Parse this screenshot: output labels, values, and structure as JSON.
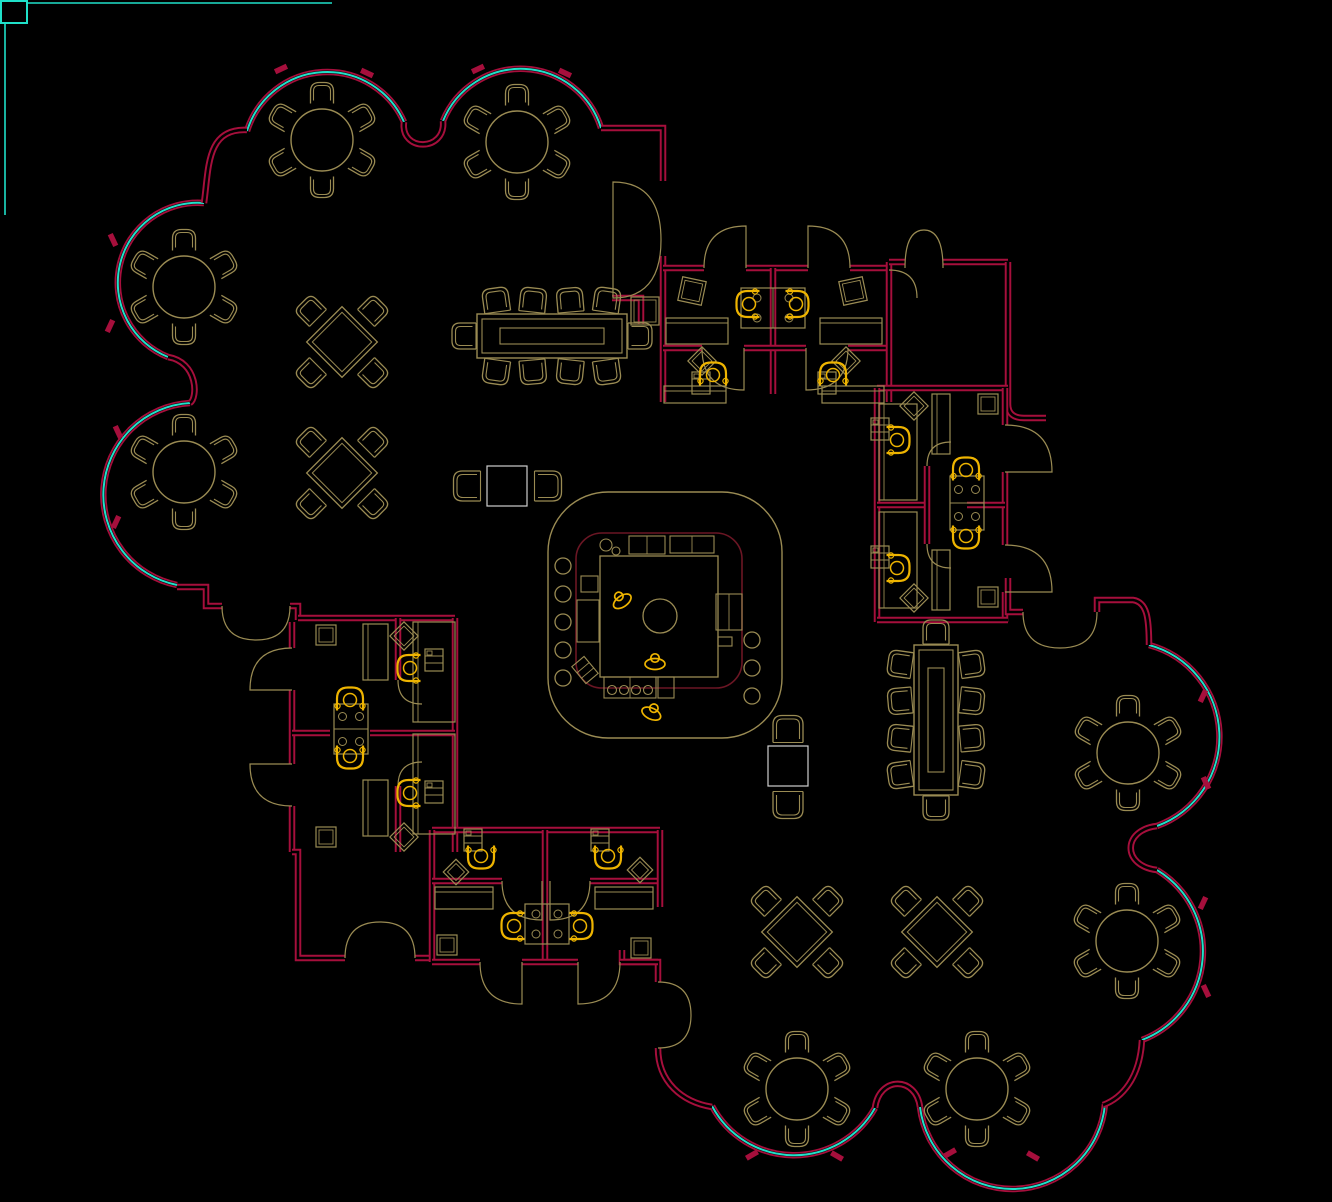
{
  "meta": {
    "type": "cad-floor-plan",
    "canvas_w": 1332,
    "canvas_h": 1202,
    "background": "#000000"
  },
  "palette": {
    "wall": "#a60f3c",
    "wall_core": "#000000",
    "glass": "#1fe0c9",
    "furniture": "#9a8b53",
    "task_chair": "#eeb400",
    "inner_line": "#6b1624",
    "light_table": "#cfcfcf",
    "frame": "#1fe0c9"
  },
  "frame": {
    "square": [
      1,
      1,
      26,
      22
    ],
    "lines": [
      [
        27,
        3,
        332,
        3
      ],
      [
        5,
        23,
        5,
        215
      ]
    ]
  },
  "plan": {
    "walls": [
      "M247,130 C206,128 209,168 204,203",
      "M601,128 L663,128 L663,181",
      "M612,298 L641,298 L641,324",
      "M663,256 L663,402",
      "M663,268 L704,268",
      "M746,268 L808,268",
      "M850,268 L889,268",
      "M773,268 L773,394",
      "M663,348 L702,348",
      "M744,348 L806,348",
      "M848,348 L889,348",
      "M889,262 L889,402",
      "M889,262 L905,262",
      "M943,262 L1008,262",
      "M1008,262 L1008,404 Q1008,418 1024,418 L1046,418",
      "M877,388 L1008,388",
      "M877,388 L877,622",
      "M1005,388 L1005,425",
      "M1005,472 L1005,545",
      "M1005,592 L1005,622",
      "M877,505 L925,505",
      "M967,505 L1005,505",
      "M927,466 L927,544",
      "M877,620 L1008,620",
      "M1008,578 L1008,612 L1023,612",
      "M1097,612 L1097,600 L1133,600 C1147,602 1149,618 1149,645",
      "M177,587 L206,587 L206,606 L222,606",
      "M290,606 L298,606 L298,620",
      "M298,618 L455,618",
      "M292,622 L292,648",
      "M292,690 L292,764",
      "M292,806 L292,852",
      "M455,618 L455,852",
      "M292,733 L330,733",
      "M370,733 L455,733",
      "M398,618 L398,680",
      "M398,786 L398,852",
      "M292,852 L298,852 L298,958 L345,958",
      "M415,958 L432,958",
      "M432,830 L660,830",
      "M432,830 L432,962",
      "M545,830 L545,962",
      "M432,881 L502,881",
      "M590,881 L660,881",
      "M660,830 L660,907",
      "M622,950 L622,962 L658,962 L658,982",
      "M432,962 L480,962",
      "M522,962 L578,962",
      "M620,962 L658,962",
      "M658,1048 C658,1082 682,1102 712,1107",
      "M1142,1040 C1140,1078 1122,1098 1103,1105"
    ],
    "glass_arcs": [
      "M247,131 A84,84 0 0 1 404,122",
      "M443,121 A84,84 0 0 1 601,128",
      "M204,203 A80,80 0 0 0 168,357",
      "M190,403 A92,92 0 0 0 177,585",
      "M1149,645 A95,95 0 0 1 1157,826",
      "M1157,870 A95,95 0 0 1 1142,1040",
      "M1105,1104 A93,93 0 0 1 920,1107",
      "M875,1108 A93,93 0 0 1 712,1106"
    ],
    "wall_pockets": [
      "M404,122 C400,152 446,152 443,121",
      "M168,357 C198,362 198,398 190,403",
      "M1157,826 C1122,830 1122,866 1157,870",
      "M920,1107 C916,1076 879,1076 875,1108"
    ],
    "mullions": [
      [
        281,
        69,
        -25
      ],
      [
        367,
        73,
        25
      ],
      [
        478,
        69,
        -25
      ],
      [
        565,
        73,
        25
      ],
      [
        113,
        240,
        65
      ],
      [
        110,
        326,
        115
      ],
      [
        118,
        432,
        65
      ],
      [
        116,
        522,
        115
      ],
      [
        1203,
        696,
        115
      ],
      [
        1206,
        783,
        65
      ],
      [
        1203,
        903,
        115
      ],
      [
        1206,
        991,
        65
      ],
      [
        950,
        1153,
        -30
      ],
      [
        1033,
        1156,
        30
      ],
      [
        752,
        1155,
        -30
      ],
      [
        837,
        1156,
        30
      ]
    ],
    "doors": [
      "M613,240 L613,182 Q661,182 661,240",
      "M613,240 L613,298 Q661,298 661,240",
      "M905,268 Q905,230 924,230",
      "M943,268 Q943,230 924,230",
      "M704,268 Q704,226 746,226 L746,268",
      "M850,268 Q850,226 808,226 L808,268",
      "M702,348 Q702,390 744,390 L744,348",
      "M848,348 Q848,390 806,390 L806,348",
      "M889,270 Q917,270 917,298",
      "M1005,425 Q1052,425 1052,472 L1005,472",
      "M1005,545 Q1052,545 1052,592 L1005,592",
      "M1023,612 Q1023,648 1060,648",
      "M1097,612 Q1097,648 1060,648",
      "M292,648 Q250,648 250,690 L292,690",
      "M292,806 Q250,806 250,764 L292,764",
      "M222,606 Q222,640 256,640",
      "M290,606 Q290,640 256,640",
      "M345,958 Q345,922 380,922",
      "M415,958 Q415,922 380,922",
      "M480,962 Q480,1004 522,1004 L522,962",
      "M620,962 Q620,1004 578,1004 L578,962",
      "M502,881 Q502,920 542,920 L542,881",
      "M590,881 Q590,920 550,920 L550,881",
      "M658,982 Q691,982 691,1015",
      "M658,1048 Q691,1048 691,1015",
      "M927,466 Q927,442 951,442",
      "M927,544 Q927,568 951,568",
      "M398,680 Q398,704 422,704",
      "M398,786 Q398,762 422,762"
    ]
  },
  "furniture": {
    "round_tables": [
      [
        322,
        140
      ],
      [
        517,
        142
      ],
      [
        184,
        287
      ],
      [
        184,
        472
      ],
      [
        1128,
        753
      ],
      [
        1127,
        941
      ],
      [
        797,
        1089
      ],
      [
        977,
        1089
      ]
    ],
    "diamond_tables": [
      [
        342,
        342,
        50
      ],
      [
        342,
        473,
        50
      ],
      [
        797,
        932,
        50
      ],
      [
        937,
        932,
        50
      ]
    ],
    "conference_tables": [
      [
        552,
        336,
        0
      ],
      [
        936,
        720,
        90
      ]
    ],
    "lounge_tables": [
      [
        507,
        486
      ],
      [
        788,
        766
      ]
    ],
    "lounge_chairs": [
      [
        467,
        486,
        270
      ],
      [
        548,
        486,
        90
      ],
      [
        788,
        729,
        0
      ],
      [
        788,
        805,
        180
      ]
    ],
    "desks": [
      [
        666,
        318,
        62,
        26
      ],
      [
        820,
        318,
        62,
        26
      ],
      [
        664,
        386,
        62,
        17
      ],
      [
        822,
        386,
        62,
        17
      ],
      [
        932,
        394,
        18,
        60
      ],
      [
        932,
        550,
        18,
        60
      ],
      [
        879,
        404,
        38,
        96
      ],
      [
        879,
        512,
        38,
        96
      ],
      [
        363,
        624,
        25,
        56
      ],
      [
        363,
        780,
        25,
        56
      ],
      [
        413,
        622,
        42,
        100
      ],
      [
        413,
        734,
        42,
        100
      ],
      [
        435,
        887,
        58,
        22
      ],
      [
        595,
        887,
        58,
        22
      ]
    ],
    "workstations": [
      [
        773,
        308,
        64,
        40,
        "v"
      ],
      [
        967,
        503,
        34,
        54,
        "h"
      ],
      [
        351,
        729,
        34,
        50,
        "h"
      ],
      [
        547,
        924,
        44,
        40,
        "v"
      ]
    ],
    "files": [
      [
        701,
        383
      ],
      [
        827,
        383
      ],
      [
        880,
        429
      ],
      [
        880,
        557
      ],
      [
        434,
        660
      ],
      [
        434,
        792
      ],
      [
        473,
        840
      ],
      [
        600,
        840
      ]
    ],
    "squares": [
      [
        692,
        291,
        24,
        12
      ],
      [
        853,
        291,
        24,
        -12
      ],
      [
        645,
        311,
        28,
        0
      ],
      [
        988,
        404,
        20,
        0
      ],
      [
        988,
        597,
        20,
        0
      ],
      [
        326,
        635,
        20,
        0
      ],
      [
        326,
        837,
        20,
        0
      ],
      [
        447,
        945,
        20,
        0
      ],
      [
        641,
        948,
        20,
        0
      ]
    ],
    "diamonds": [
      [
        702,
        361,
        20
      ],
      [
        846,
        361,
        20
      ],
      [
        914,
        406,
        20
      ],
      [
        914,
        598,
        20
      ],
      [
        404,
        636,
        20
      ],
      [
        404,
        837,
        20
      ],
      [
        456,
        872,
        18
      ],
      [
        640,
        870,
        18
      ]
    ],
    "task_chairs": [
      [
        748,
        304,
        90
      ],
      [
        797,
        304,
        -90
      ],
      [
        713,
        374,
        180
      ],
      [
        833,
        374,
        180
      ],
      [
        898,
        440,
        -90
      ],
      [
        898,
        568,
        -90
      ],
      [
        966,
        469,
        180
      ],
      [
        966,
        537,
        0
      ],
      [
        409,
        668,
        90
      ],
      [
        409,
        793,
        90
      ],
      [
        350,
        699,
        180
      ],
      [
        350,
        757,
        0
      ],
      [
        481,
        857,
        0
      ],
      [
        608,
        857,
        0
      ],
      [
        513,
        926,
        90
      ],
      [
        581,
        926,
        -90
      ]
    ],
    "people": [
      [
        620,
        598,
        -35
      ],
      [
        655,
        660,
        0
      ],
      [
        653,
        710,
        25
      ]
    ]
  },
  "kitchen": {
    "outer": [
      548,
      492,
      234,
      246,
      60
    ],
    "inner": [
      576,
      533,
      166,
      155,
      26
    ],
    "counter": [
      600,
      556,
      118,
      121
    ],
    "circle": [
      660,
      616,
      17
    ],
    "stools": [
      [
        563,
        566
      ],
      [
        563,
        594
      ],
      [
        563,
        622
      ],
      [
        563,
        650
      ],
      [
        563,
        678
      ],
      [
        752,
        640
      ],
      [
        752,
        668
      ],
      [
        752,
        696
      ]
    ],
    "equip_rects": [
      [
        629,
        536,
        36,
        18
      ],
      [
        670,
        536,
        44,
        17
      ],
      [
        581,
        576,
        17,
        16
      ],
      [
        577,
        600,
        22,
        42
      ],
      [
        716,
        594,
        26,
        36
      ],
      [
        718,
        637,
        14,
        9
      ],
      [
        604,
        677,
        52,
        21
      ],
      [
        658,
        677,
        16,
        21
      ]
    ],
    "equip_circles": [
      [
        606,
        545,
        6
      ],
      [
        616,
        551,
        4
      ],
      [
        612,
        690,
        4.5
      ],
      [
        624,
        690,
        4.5
      ],
      [
        636,
        690,
        4.5
      ],
      [
        648,
        690,
        4.5
      ]
    ],
    "tilted_rect": [
      585,
      670,
      16,
      22,
      -40
    ]
  }
}
